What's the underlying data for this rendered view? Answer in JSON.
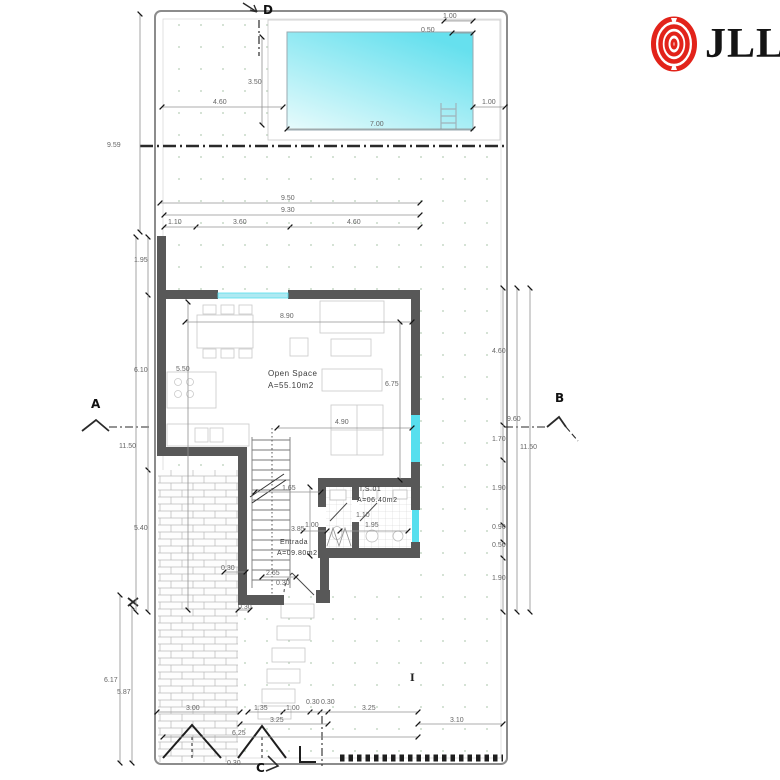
{
  "brand": {
    "name": "JLL",
    "logo_icon": "jll-rings-icon",
    "logo_color": "#e2231a",
    "text_color": "#141414"
  },
  "rooms": {
    "open_space": {
      "name": "Open Space",
      "area": "A=55.10m2"
    },
    "entrada": {
      "name": "Entrada",
      "area": "A=09.80m2"
    },
    "is01": {
      "name": "I.S.01",
      "area": "A=06.40m2"
    }
  },
  "section_markers": {
    "a": "A",
    "b": "B",
    "c": "C",
    "d": "D"
  },
  "symbols": {
    "beam": "I"
  },
  "colors": {
    "window": "#57dfee",
    "pool_dark": "#66e0ee",
    "pool_light": "#e8fbfc",
    "wall": "#585858"
  },
  "dims": {
    "pool_top_offset": "1.00",
    "pool_top_offset2": "0.50",
    "pool_height": "3.50",
    "pool_left_gap": "4.60",
    "pool_right_gap": "1.00",
    "pool_width": "7.00",
    "site_upper_height": "9.59",
    "house_top_total": "9.50",
    "house_top_inner": "9.30",
    "house_top_a": "1.10",
    "house_top_b": "3.60",
    "house_top_c": "4.60",
    "left_a": "1.95",
    "left_b": "6.10",
    "left_total": "11.50",
    "left_c": "5.40",
    "left_d": "6.17",
    "left_e": "5.87",
    "right_a": "4.60",
    "right_b": "9.60",
    "right_c": "1.70",
    "right_total": "11.50",
    "right_d": "1.90",
    "right_e": "0.90",
    "right_f": "0.50",
    "right_g": "1.90",
    "room_width": "8.90",
    "kitchen_depth": "5.50",
    "room_depth": "6.75",
    "room_lower": "4.90",
    "hall_a": "1.65",
    "bath_depth": "3.85",
    "bath_door": "1.00",
    "bath_width": "1.95",
    "bath_inner": "1.10",
    "entry_a": "2.65",
    "entry_b": "0.30",
    "entry_c": "0.30",
    "entry_d": "0.30",
    "bottom_a": "3.00",
    "bottom_b": "1.35",
    "bottom_c": "1.00",
    "bottom_d": "0.30",
    "bottom_e": "0.30",
    "bottom_f": "3.25",
    "bottom_g": "3.25",
    "bottom_h": "3.10",
    "bottom_i": "6.25",
    "bottom_j": "0.30"
  }
}
